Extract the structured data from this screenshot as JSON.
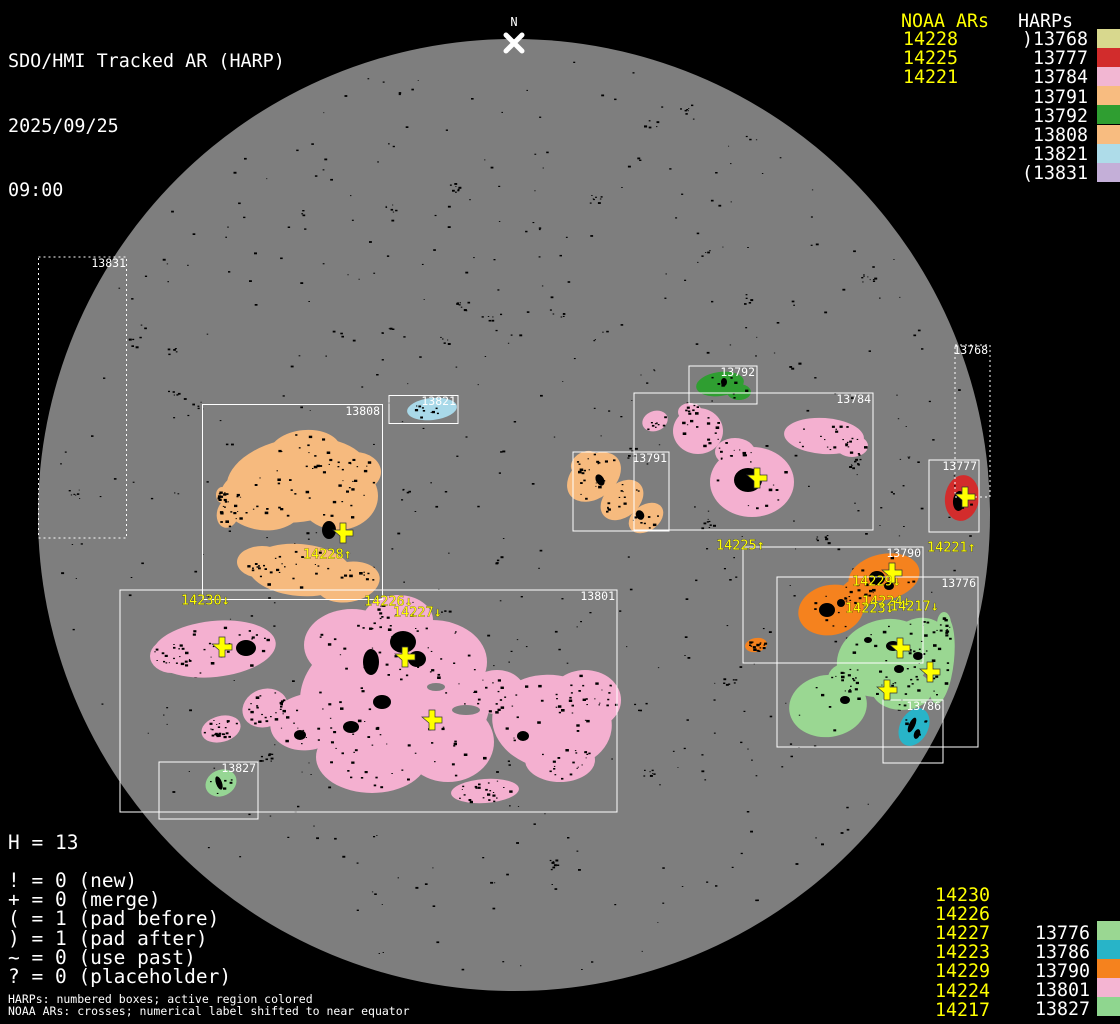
{
  "header": {
    "title": "SDO/HMI Tracked AR (HARP)",
    "date": "2025/09/25",
    "time": "09:00"
  },
  "north_marker": {
    "label": "N",
    "x": 514,
    "y": 43
  },
  "colors": {
    "background": "#000000",
    "disk": "#7e7e7e",
    "box_stroke": "#ffffff",
    "noaa_yellow": "#ffff00",
    "text_white": "#ffffff",
    "speckle": "#000000"
  },
  "disk": {
    "cx": 514,
    "cy": 515,
    "r": 476
  },
  "legend_top_right": {
    "noaa_header": "NOAA ARs",
    "harps_header": "HARPs",
    "noaa_items": [
      "14228",
      "14225",
      "14221"
    ],
    "harp_items": [
      {
        "label": ")13768",
        "color": "#d8d88e"
      },
      {
        "label": "13777",
        "color": "#d22c2c"
      },
      {
        "label": "13784",
        "color": "#f2b6d2"
      },
      {
        "label": "13791",
        "color": "#f8bc80"
      },
      {
        "label": "13792",
        "color": "#2f9e31"
      },
      {
        "label": "13808",
        "color": "#f8bc80"
      },
      {
        "label": "13821",
        "color": "#aedce9"
      },
      {
        "label": "(13831",
        "color": "#c4afd8"
      }
    ]
  },
  "legend_bottom_right": {
    "noaa_items": [
      "14230",
      "14226",
      "14227",
      "14223",
      "14229",
      "14224",
      "14217"
    ],
    "harp_items": [
      {
        "label": "13776",
        "color": "#9ad792"
      },
      {
        "label": "13786",
        "color": "#28b4c8"
      },
      {
        "label": "13790",
        "color": "#f5821e"
      },
      {
        "label": "13801",
        "color": "#f4b4d2"
      },
      {
        "label": "13827",
        "color": "#8fd68f"
      }
    ]
  },
  "stats": {
    "harp_count": "H = 13"
  },
  "flag_legend": [
    "! = 0 (new)",
    "+ = 0 (merge)",
    "( = 1 (pad before)",
    ") = 1 (pad after)",
    "~ = 0 (use past)",
    "? = 0 (placeholder)"
  ],
  "footnotes": [
    "HARPs: numbered boxes; active region colored",
    "NOAA ARs: crosses; numerical label shifted to near equator"
  ],
  "regions": [
    {
      "harp": "13831",
      "box": {
        "x": 38.5,
        "y": 257,
        "w": 88,
        "h": 281
      },
      "dotted": true,
      "label_x": 126,
      "label_y": 258,
      "color": "#c4afd8",
      "blobs": [],
      "spots": [],
      "speckles": 0
    },
    {
      "harp": "13768",
      "box": {
        "x": 955,
        "y": 345,
        "w": 35,
        "h": 152
      },
      "dotted": true,
      "label_x": 988,
      "label_y": 345,
      "color": "#d8d88e",
      "blobs": [],
      "spots": [],
      "speckles": 0
    },
    {
      "harp": "13808",
      "box": {
        "x": 202.5,
        "y": 404.5,
        "w": 180,
        "h": 195
      },
      "dotted": false,
      "label_x": 380,
      "label_y": 406,
      "color": "#f6ba7e",
      "blobs": [
        [
          298,
          480,
          72,
          42,
          -8
        ],
        [
          262,
          500,
          42,
          30,
          10
        ],
        [
          338,
          496,
          40,
          34,
          0
        ],
        [
          305,
          452,
          36,
          22,
          -5
        ],
        [
          355,
          472,
          26,
          20,
          0
        ],
        [
          300,
          570,
          52,
          26,
          5
        ],
        [
          348,
          582,
          32,
          20,
          -10
        ],
        [
          262,
          562,
          25,
          16,
          0
        ],
        [
          228,
          513,
          11,
          15,
          15
        ],
        [
          222,
          495,
          6,
          8,
          0
        ]
      ],
      "spots": [
        [
          329,
          530,
          7,
          9,
          0
        ]
      ],
      "speckles": 130
    },
    {
      "harp": "13821",
      "box": {
        "x": 389,
        "y": 395.5,
        "w": 69,
        "h": 28
      },
      "dotted": false,
      "label_x": 456,
      "label_y": 396,
      "color": "#a9d9e9",
      "blobs": [
        [
          432,
          409,
          25,
          11,
          -6
        ]
      ],
      "spots": [],
      "speckles": 10
    },
    {
      "harp": "13801",
      "box": {
        "x": 120,
        "y": 590,
        "w": 497,
        "h": 222
      },
      "dotted": false,
      "label_x": 615,
      "label_y": 591,
      "color": "#f4b0d0",
      "blobs": [
        [
          214,
          649,
          62,
          28,
          -6
        ],
        [
          172,
          656,
          22,
          17,
          0
        ],
        [
          265,
          708,
          23,
          19,
          -20
        ],
        [
          221,
          729,
          20,
          13,
          -15
        ],
        [
          395,
          700,
          95,
          72,
          0
        ],
        [
          352,
          645,
          48,
          36,
          0
        ],
        [
          432,
          662,
          55,
          42,
          0
        ],
        [
          372,
          757,
          56,
          36,
          0
        ],
        [
          448,
          742,
          46,
          40,
          0
        ],
        [
          308,
          722,
          38,
          28,
          -10
        ],
        [
          398,
          620,
          35,
          25,
          0
        ],
        [
          497,
          692,
          28,
          22,
          0
        ],
        [
          552,
          722,
          60,
          47,
          8
        ],
        [
          585,
          700,
          36,
          30,
          0
        ],
        [
          560,
          760,
          35,
          22,
          0
        ],
        [
          485,
          791,
          34,
          12,
          -4
        ]
      ],
      "holes": [
        [
          466,
          710,
          14,
          5,
          0
        ],
        [
          436,
          687,
          9,
          4,
          0
        ]
      ],
      "spots": [
        [
          403,
          642,
          13,
          11,
          0
        ],
        [
          417,
          659,
          9,
          8,
          0
        ],
        [
          371,
          662,
          8,
          13,
          0
        ],
        [
          246,
          648,
          10,
          8,
          0
        ],
        [
          382,
          702,
          9,
          7,
          0
        ],
        [
          351,
          727,
          8,
          6,
          0
        ],
        [
          300,
          735,
          6,
          5,
          0
        ],
        [
          523,
          736,
          6,
          5,
          0
        ]
      ],
      "speckles": 330
    },
    {
      "harp": "13827",
      "box": {
        "x": 159,
        "y": 762,
        "w": 99,
        "h": 57
      },
      "dotted": false,
      "label_x": 256,
      "label_y": 763,
      "color": "#96d694",
      "blobs": [
        [
          221,
          783,
          16,
          13,
          -25
        ]
      ],
      "spots": [
        [
          219,
          783,
          3,
          7,
          -20
        ]
      ],
      "speckles": 6
    },
    {
      "harp": "13792",
      "box": {
        "x": 689,
        "y": 366,
        "w": 68,
        "h": 38
      },
      "dotted": false,
      "label_x": 755,
      "label_y": 367,
      "color": "#2f9e31",
      "blobs": [
        [
          720,
          384,
          24,
          12,
          -8
        ],
        [
          739,
          392,
          12,
          8,
          0
        ]
      ],
      "spots": [
        [
          724,
          382,
          3,
          4,
          0
        ]
      ],
      "speckles": 8
    },
    {
      "harp": "13784",
      "box": {
        "x": 634,
        "y": 393,
        "w": 239,
        "h": 137
      },
      "dotted": false,
      "label_x": 871,
      "label_y": 394,
      "color": "#f4b0d0",
      "blobs": [
        [
          655,
          421,
          13,
          10,
          -20
        ],
        [
          698,
          431,
          25,
          23,
          0
        ],
        [
          690,
          412,
          12,
          9,
          0
        ],
        [
          824,
          436,
          40,
          18,
          4
        ],
        [
          852,
          446,
          16,
          11,
          0
        ],
        [
          752,
          482,
          42,
          35,
          0
        ],
        [
          735,
          452,
          20,
          14,
          0
        ]
      ],
      "spots": [
        [
          748,
          480,
          14,
          12,
          0
        ]
      ],
      "speckles": 80
    },
    {
      "harp": "13791",
      "box": {
        "x": 573,
        "y": 452,
        "w": 96,
        "h": 79
      },
      "dotted": false,
      "label_x": 667,
      "label_y": 453,
      "color": "#f6ba7e",
      "blobs": [
        [
          594,
          477,
          30,
          21,
          -38
        ],
        [
          622,
          500,
          24,
          17,
          -40
        ],
        [
          646,
          518,
          19,
          13,
          -35
        ],
        [
          585,
          463,
          15,
          11,
          -30
        ]
      ],
      "spots": [
        [
          600,
          480,
          4,
          6,
          -30
        ],
        [
          640,
          515,
          4,
          5,
          -30
        ]
      ],
      "speckles": 45
    },
    {
      "harp": "13777",
      "box": {
        "x": 929,
        "y": 460,
        "w": 50,
        "h": 72
      },
      "dotted": false,
      "label_x": 977,
      "label_y": 461,
      "color": "#d22c2c",
      "blobs": [
        [
          962,
          498,
          17,
          23,
          8
        ]
      ],
      "spots": [
        [
          959,
          501,
          6,
          10,
          5
        ]
      ],
      "speckles": 4
    },
    {
      "harp": "13790",
      "box": {
        "x": 743,
        "y": 547,
        "w": 180,
        "h": 116
      },
      "dotted": false,
      "label_x": 921,
      "label_y": 548,
      "color": "#f5821e",
      "blobs": [
        [
          884,
          577,
          36,
          23,
          -12
        ],
        [
          858,
          593,
          22,
          15,
          -30
        ],
        [
          831,
          610,
          33,
          25,
          -12
        ],
        [
          756,
          645,
          11,
          7,
          -10
        ]
      ],
      "spots": [
        [
          877,
          578,
          8,
          7,
          0
        ],
        [
          889,
          586,
          5,
          4,
          0
        ],
        [
          827,
          610,
          8,
          7,
          0
        ],
        [
          841,
          603,
          4,
          4,
          0
        ]
      ],
      "speckles": 55
    },
    {
      "harp": "13776",
      "box": {
        "x": 777,
        "y": 577,
        "w": 201,
        "h": 170
      },
      "dotted": false,
      "label_x": 976,
      "label_y": 578,
      "color": "#9ad792",
      "blobs": [
        [
          884,
          658,
          48,
          38,
          -18
        ],
        [
          920,
          638,
          26,
          20,
          -10
        ],
        [
          902,
          690,
          30,
          20,
          0
        ],
        [
          828,
          706,
          39,
          31,
          -8
        ],
        [
          848,
          678,
          20,
          15,
          0
        ],
        [
          941,
          660,
          13,
          44,
          6
        ],
        [
          944,
          624,
          7,
          12,
          0
        ]
      ],
      "spots": [
        [
          893,
          646,
          7,
          5,
          0
        ],
        [
          918,
          656,
          5,
          4,
          0
        ],
        [
          899,
          669,
          5,
          4,
          0
        ],
        [
          845,
          700,
          5,
          4,
          0
        ],
        [
          868,
          640,
          4,
          3,
          0
        ]
      ],
      "speckles": 95
    },
    {
      "harp": "13786",
      "box": {
        "x": 883,
        "y": 700,
        "w": 60,
        "h": 63
      },
      "dotted": false,
      "label_x": 941,
      "label_y": 701,
      "color": "#28b4c8",
      "blobs": [
        [
          914,
          727,
          14,
          20,
          28
        ]
      ],
      "spots": [
        [
          912,
          725,
          3,
          8,
          25
        ],
        [
          917,
          734,
          3,
          5,
          20
        ]
      ],
      "speckles": 5
    }
  ],
  "noaa_crosses": [
    [
      343,
      533
    ],
    [
      222,
      647
    ],
    [
      405,
      657
    ],
    [
      432,
      720
    ],
    [
      757,
      478
    ],
    [
      965,
      497
    ],
    [
      892,
      573
    ],
    [
      900,
      648
    ],
    [
      930,
      672
    ],
    [
      887,
      690
    ]
  ],
  "noaa_ar_labels": [
    {
      "text": "14228↑",
      "x": 303,
      "y": 549
    },
    {
      "text": "14230↓",
      "x": 181,
      "y": 595
    },
    {
      "text": "14226↓",
      "x": 364,
      "y": 596
    },
    {
      "text": "14227↓",
      "x": 393,
      "y": 607
    },
    {
      "text": "14225↑",
      "x": 716,
      "y": 540
    },
    {
      "text": "14221↑",
      "x": 927,
      "y": 542
    },
    {
      "text": "14229↓",
      "x": 852,
      "y": 576
    },
    {
      "text": "14224↓",
      "x": 862,
      "y": 596
    },
    {
      "text": "14223↓",
      "x": 845,
      "y": 603
    },
    {
      "text": "14217↓",
      "x": 890,
      "y": 601
    }
  ]
}
